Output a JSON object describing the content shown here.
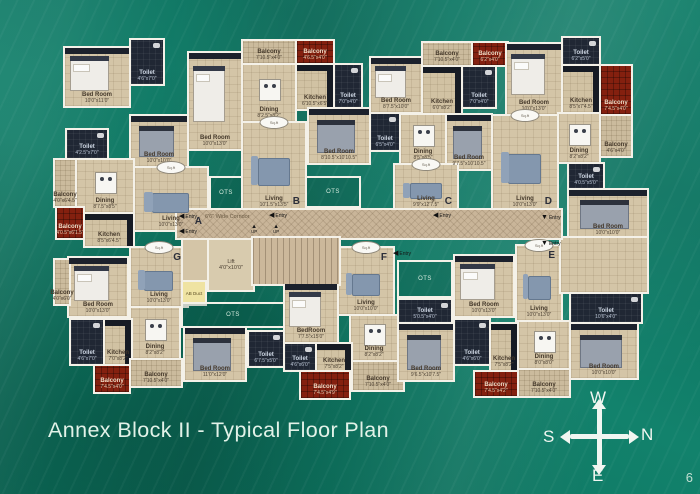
{
  "slide": {
    "title": "Annex Block II - Typical Floor Plan",
    "page_number": "6"
  },
  "compass": {
    "top": "W",
    "right": "N",
    "left": "S",
    "bottom": "E"
  },
  "colors": {
    "board_green": "#12826c",
    "floor_tan": "#d4c5a7",
    "dark_room": "#202734",
    "balcony_red": "#84200f",
    "wall_white": "#f4f1e8",
    "title_text": "#e2f2e8"
  },
  "plan": {
    "corridor_label": "6'6\" Wide Corridor",
    "lift_label": "Lift",
    "lift_dim": "4'0\"x10'0\"",
    "duct_label": "AB Duct",
    "ots_label": "OTS",
    "entry_label": "Entry",
    "up_label": "UP",
    "stamp_label": "Sq.ft",
    "units": [
      "A",
      "B",
      "C",
      "D",
      "E",
      "F",
      "G"
    ],
    "rooms": [
      {
        "unit": "A",
        "name": "bedroom-1",
        "type": "tan",
        "x": 10,
        "y": 40,
        "w": 64,
        "h": 58,
        "label": "Bed Room",
        "dim": "10'0\"x11'0\"",
        "furn": "bed",
        "wr": true
      },
      {
        "unit": "A",
        "name": "toilet-1",
        "type": "dark",
        "x": 76,
        "y": 32,
        "w": 32,
        "h": 44,
        "label": "Toilet",
        "dim": "4'6\"x7'0\""
      },
      {
        "unit": "A",
        "name": "bedroom-2",
        "type": "tan",
        "x": 76,
        "y": 108,
        "w": 56,
        "h": 50,
        "label": "Bed Room",
        "dim": "10'0\"x10'0\"",
        "furn": "bedg",
        "wr": true
      },
      {
        "unit": "A",
        "name": "toilet-2",
        "type": "dark",
        "x": 12,
        "y": 122,
        "w": 40,
        "h": 28,
        "label": "Toilet",
        "dim": "4'2.5\"x7'0\""
      },
      {
        "unit": "A",
        "name": "balcony-1",
        "type": "balc",
        "x": 0,
        "y": 152,
        "w": 20,
        "h": 46,
        "label": "Balcony",
        "dim": "4'0\"x6'4.5\""
      },
      {
        "unit": "A",
        "name": "dining",
        "type": "tan",
        "x": 22,
        "y": 152,
        "w": 56,
        "h": 52,
        "label": "Dining",
        "dim": "8'7.5\"x8'5\"",
        "furn": "table"
      },
      {
        "unit": "A",
        "name": "living",
        "type": "tan",
        "x": 80,
        "y": 160,
        "w": 72,
        "h": 62,
        "label": "Living",
        "dim": "10'0\"x13'0\"",
        "furn": "sofa",
        "letter": "A",
        "lpos": "br",
        "stamp": true
      },
      {
        "unit": "A",
        "name": "balcony-2",
        "type": "red",
        "x": 2,
        "y": 200,
        "w": 26,
        "h": 30,
        "label": "Balcony",
        "dim": "4'0.5\"x6'1.5\""
      },
      {
        "unit": "A",
        "name": "kitchen",
        "type": "kit",
        "x": 30,
        "y": 206,
        "w": 48,
        "h": 32,
        "label": "Kitchen",
        "dim": "8'5\"x6'4.5\""
      },
      {
        "unit": "B",
        "name": "bedroom-1",
        "type": "tan",
        "x": 134,
        "y": 45,
        "w": 52,
        "h": 96,
        "label": "Bed Room",
        "dim": "10'0\"x13'0\"",
        "furn": "bed",
        "wr": true
      },
      {
        "unit": "B",
        "name": "balcony-1",
        "type": "balc",
        "x": 188,
        "y": 33,
        "w": 52,
        "h": 22,
        "label": "Balcony",
        "dim": "7'10.5\"x4'0\""
      },
      {
        "unit": "B",
        "name": "balcony-2",
        "type": "red",
        "x": 242,
        "y": 33,
        "w": 36,
        "h": 22,
        "label": "Balcony",
        "dim": "4'6.5\"x4'0\""
      },
      {
        "unit": "B",
        "name": "dining",
        "type": "tan",
        "x": 188,
        "y": 57,
        "w": 52,
        "h": 56,
        "label": "Dining",
        "dim": "8'2.5\"x8'2\"",
        "furn": "table"
      },
      {
        "unit": "B",
        "name": "kitchen",
        "type": "kit",
        "x": 242,
        "y": 57,
        "w": 36,
        "h": 44,
        "label": "Kitchen",
        "dim": "6'10.5\"x6'5\""
      },
      {
        "unit": "B",
        "name": "toilet-1",
        "type": "dark",
        "x": 280,
        "y": 57,
        "w": 26,
        "h": 42,
        "label": "Toilet",
        "dim": "7'0\"x4'0\""
      },
      {
        "unit": "B",
        "name": "bedroom-2",
        "type": "tan",
        "x": 254,
        "y": 101,
        "w": 60,
        "h": 54,
        "label": "Bed Room",
        "dim": "8'10.5\"x10'10.5\"",
        "furn": "bedg",
        "wr": true
      },
      {
        "unit": "B",
        "name": "living",
        "type": "tan",
        "x": 188,
        "y": 115,
        "w": 62,
        "h": 87,
        "label": "Living",
        "dim": "10'1.5\"x13'5\"",
        "furn": "sofa",
        "letter": "B",
        "lpos": "br",
        "stamp": true
      },
      {
        "unit": "C",
        "name": "balcony-1",
        "type": "balc",
        "x": 368,
        "y": 35,
        "w": 48,
        "h": 22,
        "label": "Balcony",
        "dim": "7'10.5\"x4'0\""
      },
      {
        "unit": "C",
        "name": "balcony-2",
        "type": "red",
        "x": 418,
        "y": 35,
        "w": 34,
        "h": 22,
        "label": "Balcony",
        "dim": "6'2\"x4'0\""
      },
      {
        "unit": "C",
        "name": "bedroom-1",
        "type": "tan",
        "x": 316,
        "y": 50,
        "w": 50,
        "h": 54,
        "label": "Bed Room",
        "dim": "8'7.5\"x10'0\"",
        "furn": "bed",
        "wr": true
      },
      {
        "unit": "C",
        "name": "kitchen",
        "type": "kit",
        "x": 368,
        "y": 59,
        "w": 38,
        "h": 46,
        "label": "Kitchen",
        "dim": "6'0\"x8'2\""
      },
      {
        "unit": "C",
        "name": "toilet-1",
        "type": "dark",
        "x": 408,
        "y": 59,
        "w": 32,
        "h": 40,
        "label": "Toilet",
        "dim": "7'0\"x4'0\""
      },
      {
        "unit": "C",
        "name": "toilet-2",
        "type": "dark",
        "x": 316,
        "y": 106,
        "w": 28,
        "h": 36,
        "label": "Toilet",
        "dim": "6'5\"x4'0\""
      },
      {
        "unit": "C",
        "name": "dining",
        "type": "tan",
        "x": 346,
        "y": 107,
        "w": 44,
        "h": 48,
        "label": "Dining",
        "dim": "8'5\"x8'5\"",
        "furn": "table"
      },
      {
        "unit": "C",
        "name": "bedroom-2",
        "type": "tan",
        "x": 392,
        "y": 107,
        "w": 44,
        "h": 54,
        "label": "Bed Room",
        "dim": "9'7.5\"x10'10.5\"",
        "furn": "bedg",
        "wr": true
      },
      {
        "unit": "C",
        "name": "living",
        "type": "tan",
        "x": 340,
        "y": 157,
        "w": 62,
        "h": 45,
        "label": "Living",
        "dim": "9'9\"x12'7.5\"",
        "furn": "sofa",
        "letter": "C",
        "lpos": "br",
        "stamp": true
      },
      {
        "unit": "D",
        "name": "bedroom-1",
        "type": "tan",
        "x": 452,
        "y": 36,
        "w": 54,
        "h": 70,
        "label": "Bed Room",
        "dim": "10'0\"x13'0\"",
        "furn": "bed",
        "wr": true
      },
      {
        "unit": "D",
        "name": "toilet-1",
        "type": "dark",
        "x": 508,
        "y": 30,
        "w": 36,
        "h": 26,
        "label": "Toilet",
        "dim": "6'2\"x5'0\""
      },
      {
        "unit": "D",
        "name": "kitchen",
        "type": "kit",
        "x": 508,
        "y": 58,
        "w": 36,
        "h": 46,
        "label": "Kitchen",
        "dim": "8'5\"x7'4.5\""
      },
      {
        "unit": "D",
        "name": "balcony-1",
        "type": "red",
        "x": 546,
        "y": 58,
        "w": 30,
        "h": 48,
        "label": "Balcony",
        "dim": "7'4.5\"x4'0\""
      },
      {
        "unit": "D",
        "name": "living",
        "type": "tan",
        "x": 438,
        "y": 108,
        "w": 64,
        "h": 94,
        "label": "Living",
        "dim": "10'0\"x13'0\"",
        "furn": "sofa",
        "letter": "D",
        "lpos": "br",
        "stamp": true
      },
      {
        "unit": "D",
        "name": "dining",
        "type": "tan",
        "x": 504,
        "y": 106,
        "w": 40,
        "h": 48,
        "label": "Dining",
        "dim": "8'2\"x8'2\"",
        "furn": "table"
      },
      {
        "unit": "D",
        "name": "balcony-2",
        "type": "balc",
        "x": 546,
        "y": 108,
        "w": 30,
        "h": 40,
        "label": "Balcony",
        "dim": "4'6\"x4'0\""
      },
      {
        "unit": "D",
        "name": "toilet-2",
        "type": "dark",
        "x": 514,
        "y": 156,
        "w": 34,
        "h": 24,
        "label": "Toilet",
        "dim": "4'0.5\"x5'0\""
      },
      {
        "unit": "D",
        "name": "bedroom-2",
        "type": "tan",
        "x": 514,
        "y": 182,
        "w": 78,
        "h": 48,
        "label": "Bed Room",
        "dim": "10'0\"x10'0\"",
        "furn": "bedg",
        "wr": true
      },
      {
        "unit": "G",
        "name": "living",
        "type": "tan",
        "x": 76,
        "y": 240,
        "w": 56,
        "h": 58,
        "label": "Living",
        "dim": "10'0\"x13'0\"",
        "furn": "sofa",
        "letter": "G",
        "lpos": "tr",
        "stamp": true
      },
      {
        "unit": "G",
        "name": "bedroom-1",
        "type": "tan",
        "x": 14,
        "y": 250,
        "w": 58,
        "h": 58,
        "label": "Bed Room",
        "dim": "10'0\"x13'0\"",
        "furn": "bed",
        "wr": true
      },
      {
        "unit": "G",
        "name": "balcony-1",
        "type": "balc",
        "x": 0,
        "y": 252,
        "w": 14,
        "h": 44,
        "label": "Balcony",
        "dim": "4'0\"x6'0\""
      },
      {
        "unit": "G",
        "name": "dining",
        "type": "tan",
        "x": 76,
        "y": 300,
        "w": 48,
        "h": 50,
        "label": "Dining",
        "dim": "8'2\"x8'2\"",
        "furn": "table"
      },
      {
        "unit": "G",
        "name": "toilet-1",
        "type": "dark",
        "x": 16,
        "y": 312,
        "w": 32,
        "h": 44,
        "label": "Toilet",
        "dim": "4'6\"x7'0\""
      },
      {
        "unit": "G",
        "name": "kitchen",
        "type": "kit",
        "x": 50,
        "y": 312,
        "w": 26,
        "h": 44,
        "label": "Kitchen",
        "dim": "7'0\"x8'2\""
      },
      {
        "unit": "G",
        "name": "balcony-2",
        "type": "red",
        "x": 40,
        "y": 358,
        "w": 34,
        "h": 26,
        "label": "Balcony",
        "dim": "7'4.5\"x4'0\""
      },
      {
        "unit": "G",
        "name": "balcony-3",
        "type": "balc",
        "x": 76,
        "y": 352,
        "w": 50,
        "h": 26,
        "label": "Balcony",
        "dim": "7'10.5\"x4'0\""
      },
      {
        "unit": "G",
        "name": "bedroom-2",
        "type": "tan",
        "x": 130,
        "y": 320,
        "w": 60,
        "h": 52,
        "label": "Bed Room",
        "dim": "11'0\"x12'0\"",
        "furn": "bedg",
        "wr": true
      },
      {
        "unit": "F",
        "name": "bedroom-1",
        "type": "tan",
        "x": 230,
        "y": 276,
        "w": 52,
        "h": 58,
        "label": "BedRoom",
        "dim": "7'7.5\"x15'0\"",
        "furn": "bed",
        "wr": true
      },
      {
        "unit": "F",
        "name": "living",
        "type": "tan",
        "x": 284,
        "y": 240,
        "w": 54,
        "h": 66,
        "label": "Living",
        "dim": "10'0\"x10'0\"",
        "furn": "sofa",
        "letter": "F",
        "lpos": "tr",
        "stamp": true
      },
      {
        "unit": "F",
        "name": "dining",
        "type": "tan",
        "x": 296,
        "y": 308,
        "w": 46,
        "h": 44,
        "label": "Dining",
        "dim": "8'2\"x8'2\"",
        "furn": "table"
      },
      {
        "unit": "F",
        "name": "toilet-1",
        "type": "dark",
        "x": 194,
        "y": 324,
        "w": 34,
        "h": 34,
        "label": "Toilet",
        "dim": "6'7.5\"x5'0\""
      },
      {
        "unit": "F",
        "name": "toilet-2",
        "type": "dark",
        "x": 230,
        "y": 336,
        "w": 30,
        "h": 26,
        "label": "Toilet",
        "dim": "4'6\"x6'0\""
      },
      {
        "unit": "F",
        "name": "kitchen",
        "type": "kit",
        "x": 262,
        "y": 336,
        "w": 34,
        "h": 28,
        "label": "Kitchen",
        "dim": "7'5\"x8'2\""
      },
      {
        "unit": "F",
        "name": "balcony-1",
        "type": "red",
        "x": 246,
        "y": 364,
        "w": 48,
        "h": 26,
        "label": "Balcony",
        "dim": "7'4.5\"x4'9\""
      },
      {
        "unit": "F",
        "name": "balcony-2",
        "type": "balc",
        "x": 298,
        "y": 354,
        "w": 50,
        "h": 28,
        "label": "Balcony",
        "dim": "7'10.5\"x4'0\""
      },
      {
        "unit": "F",
        "name": "toilet-3",
        "type": "dark",
        "x": 344,
        "y": 292,
        "w": 52,
        "h": 22,
        "label": "Toilet",
        "dim": "5'0.5\"x4'0\""
      },
      {
        "unit": "F",
        "name": "bedroom-2",
        "type": "tan",
        "x": 344,
        "y": 316,
        "w": 54,
        "h": 56,
        "label": "Bed Room",
        "dim": "9'6.5\"x10'7.5\"",
        "furn": "bedg",
        "wr": true
      },
      {
        "unit": "E",
        "name": "bedroom-1",
        "type": "tan",
        "x": 400,
        "y": 248,
        "w": 58,
        "h": 60,
        "label": "Bed Room",
        "dim": "10'0\"x13'0\"",
        "furn": "bed",
        "wr": true
      },
      {
        "unit": "E",
        "name": "living",
        "type": "tan",
        "x": 462,
        "y": 238,
        "w": 44,
        "h": 74,
        "label": "Living",
        "dim": "10'0\"x13'0\"",
        "furn": "sofa",
        "letter": "E",
        "lpos": "tr",
        "stamp": true
      },
      {
        "unit": "E",
        "name": "hall",
        "type": "tan",
        "x": 506,
        "y": 230,
        "w": 86,
        "h": 54,
        "label": "",
        "dim": ""
      },
      {
        "unit": "E",
        "name": "dining",
        "type": "tan",
        "x": 464,
        "y": 314,
        "w": 50,
        "h": 46,
        "label": "Dining",
        "dim": "8'0\"x8'0\"",
        "furn": "table"
      },
      {
        "unit": "E",
        "name": "toilet-1",
        "type": "dark",
        "x": 400,
        "y": 312,
        "w": 34,
        "h": 44,
        "label": "Toilet",
        "dim": "4'6\"x6'0\""
      },
      {
        "unit": "E",
        "name": "kitchen",
        "type": "kit",
        "x": 436,
        "y": 316,
        "w": 26,
        "h": 46,
        "label": "Kitchen",
        "dim": "7'5\"x8'2\""
      },
      {
        "unit": "E",
        "name": "balcony-1",
        "type": "red",
        "x": 420,
        "y": 364,
        "w": 42,
        "h": 24,
        "label": "Balcony",
        "dim": "7'4.5\"x4'2\""
      },
      {
        "unit": "E",
        "name": "balcony-2",
        "type": "balc",
        "x": 464,
        "y": 362,
        "w": 50,
        "h": 26,
        "label": "Balcony",
        "dim": "7'10.5\"x4'0\""
      },
      {
        "unit": "E",
        "name": "toilet-2",
        "type": "dark",
        "x": 516,
        "y": 286,
        "w": 70,
        "h": 28,
        "label": "Toilet",
        "dim": "10'6\"x4'0\""
      },
      {
        "unit": "E",
        "name": "bedroom-2",
        "type": "tan",
        "x": 516,
        "y": 316,
        "w": 66,
        "h": 54,
        "label": "Bed Room",
        "dim": "10'0\"x10'0\"",
        "furn": "bedg",
        "wr": true
      }
    ],
    "corridor": {
      "x": 122,
      "y": 202,
      "w": 384,
      "h": 28
    },
    "lift": {
      "x": 154,
      "y": 232,
      "w": 44,
      "h": 50
    },
    "stairs": {
      "x": 198,
      "y": 230,
      "w": 86,
      "h": 46
    },
    "duct": {
      "x": 128,
      "y": 274,
      "w": 22,
      "h": 22
    },
    "lobby": {
      "x": 128,
      "y": 232,
      "w": 24,
      "h": 40
    },
    "ots_areas": [
      {
        "x": 156,
        "y": 170,
        "w": 30,
        "h": 30
      },
      {
        "x": 252,
        "y": 170,
        "w": 52,
        "h": 28
      },
      {
        "x": 128,
        "y": 296,
        "w": 100,
        "h": 22
      },
      {
        "x": 344,
        "y": 254,
        "w": 52,
        "h": 34
      }
    ],
    "entries": [
      {
        "unit": "A",
        "x": 124,
        "y": 205,
        "dir": "left"
      },
      {
        "unit": "G",
        "x": 124,
        "y": 220,
        "dir": "left"
      },
      {
        "unit": "B",
        "x": 214,
        "y": 204,
        "dir": "left"
      },
      {
        "unit": "C",
        "x": 378,
        "y": 204,
        "dir": "left"
      },
      {
        "unit": "D",
        "x": 486,
        "y": 206,
        "dir": "down"
      },
      {
        "unit": "F",
        "x": 338,
        "y": 242,
        "dir": "left"
      },
      {
        "unit": "E",
        "x": 486,
        "y": 232,
        "dir": "down"
      }
    ],
    "up_marks": [
      {
        "x": 196,
        "y": 216
      },
      {
        "x": 218,
        "y": 216
      }
    ],
    "arrow_left": "◀",
    "arrow_down": "▼",
    "arrow_up": "▲"
  }
}
